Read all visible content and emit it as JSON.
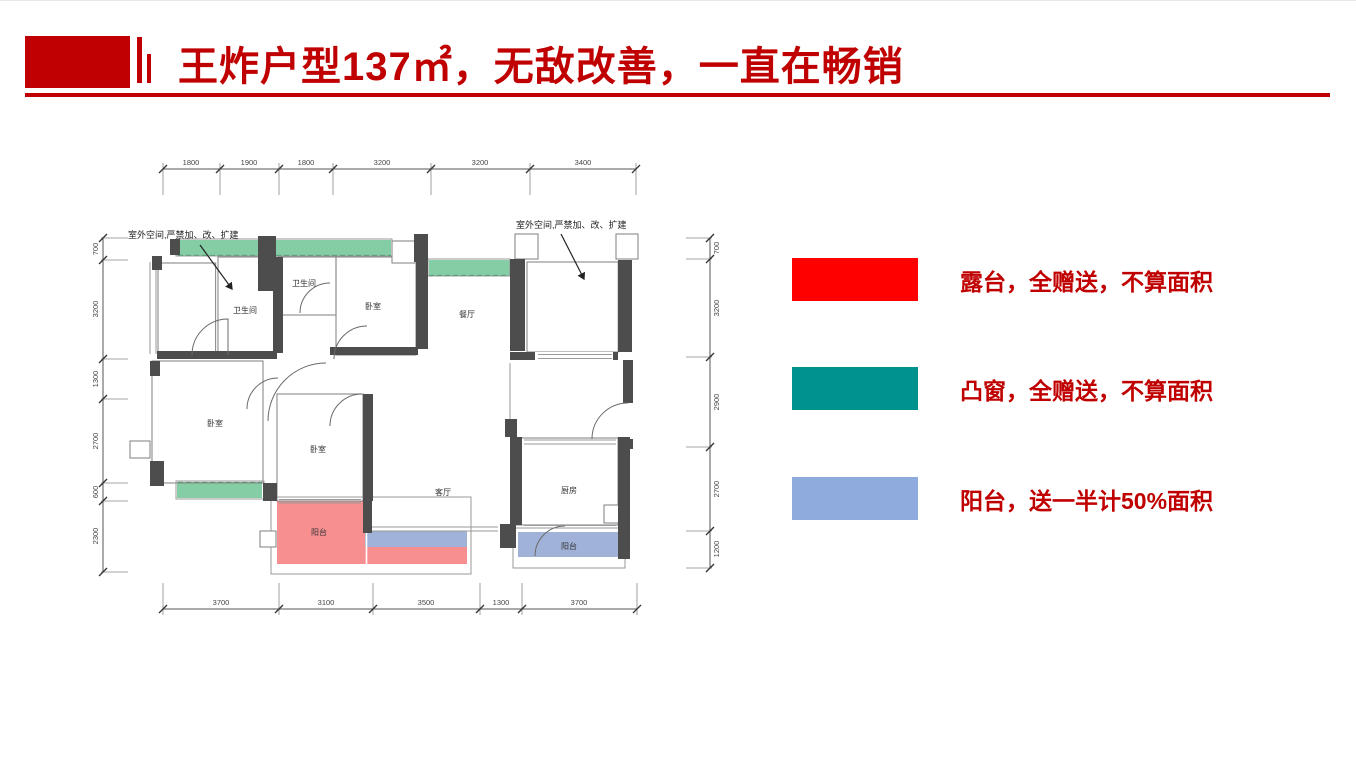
{
  "header": {
    "title": "王炸户型137㎡，无敌改善，一直在畅销",
    "accent_color": "#C00000"
  },
  "plan": {
    "dims_top": [
      "1800",
      "1900",
      "1800",
      "3200",
      "3200",
      "3400"
    ],
    "dims_bottom": [
      "3700",
      "3100",
      "3500",
      "1300",
      "3700"
    ],
    "dims_left": [
      "700",
      "3200",
      "1300",
      "2700",
      "600",
      "2300"
    ],
    "dims_right": [
      "700",
      "3200",
      "2900",
      "2700",
      "1200"
    ],
    "rooms": {
      "bath1": "卫生间",
      "bath2": "卫生间",
      "bed_top": "卧室",
      "dining": "餐厅",
      "bed_left": "卧室",
      "bed_mid": "卧室",
      "living": "客厅",
      "kitchen": "厨房",
      "terrace": "阳台",
      "balcony": "阳台"
    },
    "annotation": "室外空间,严禁加、改、扩建",
    "colors": {
      "bay": "#85CDA4",
      "terrace": "#F78F91",
      "balcony": "#A0B2D7",
      "wall": "#4D4D4D"
    }
  },
  "legend": {
    "text_color": "#C00000",
    "items": [
      {
        "name": "terrace",
        "color": "#FE0000",
        "label": "露台，全赠送，不算面积"
      },
      {
        "name": "bay-window",
        "color": "#00938E",
        "label": "凸窗，全赠送，不算面积"
      },
      {
        "name": "balcony",
        "color": "#8FAADC",
        "label": "阳台，送一半计50%面积"
      }
    ]
  }
}
